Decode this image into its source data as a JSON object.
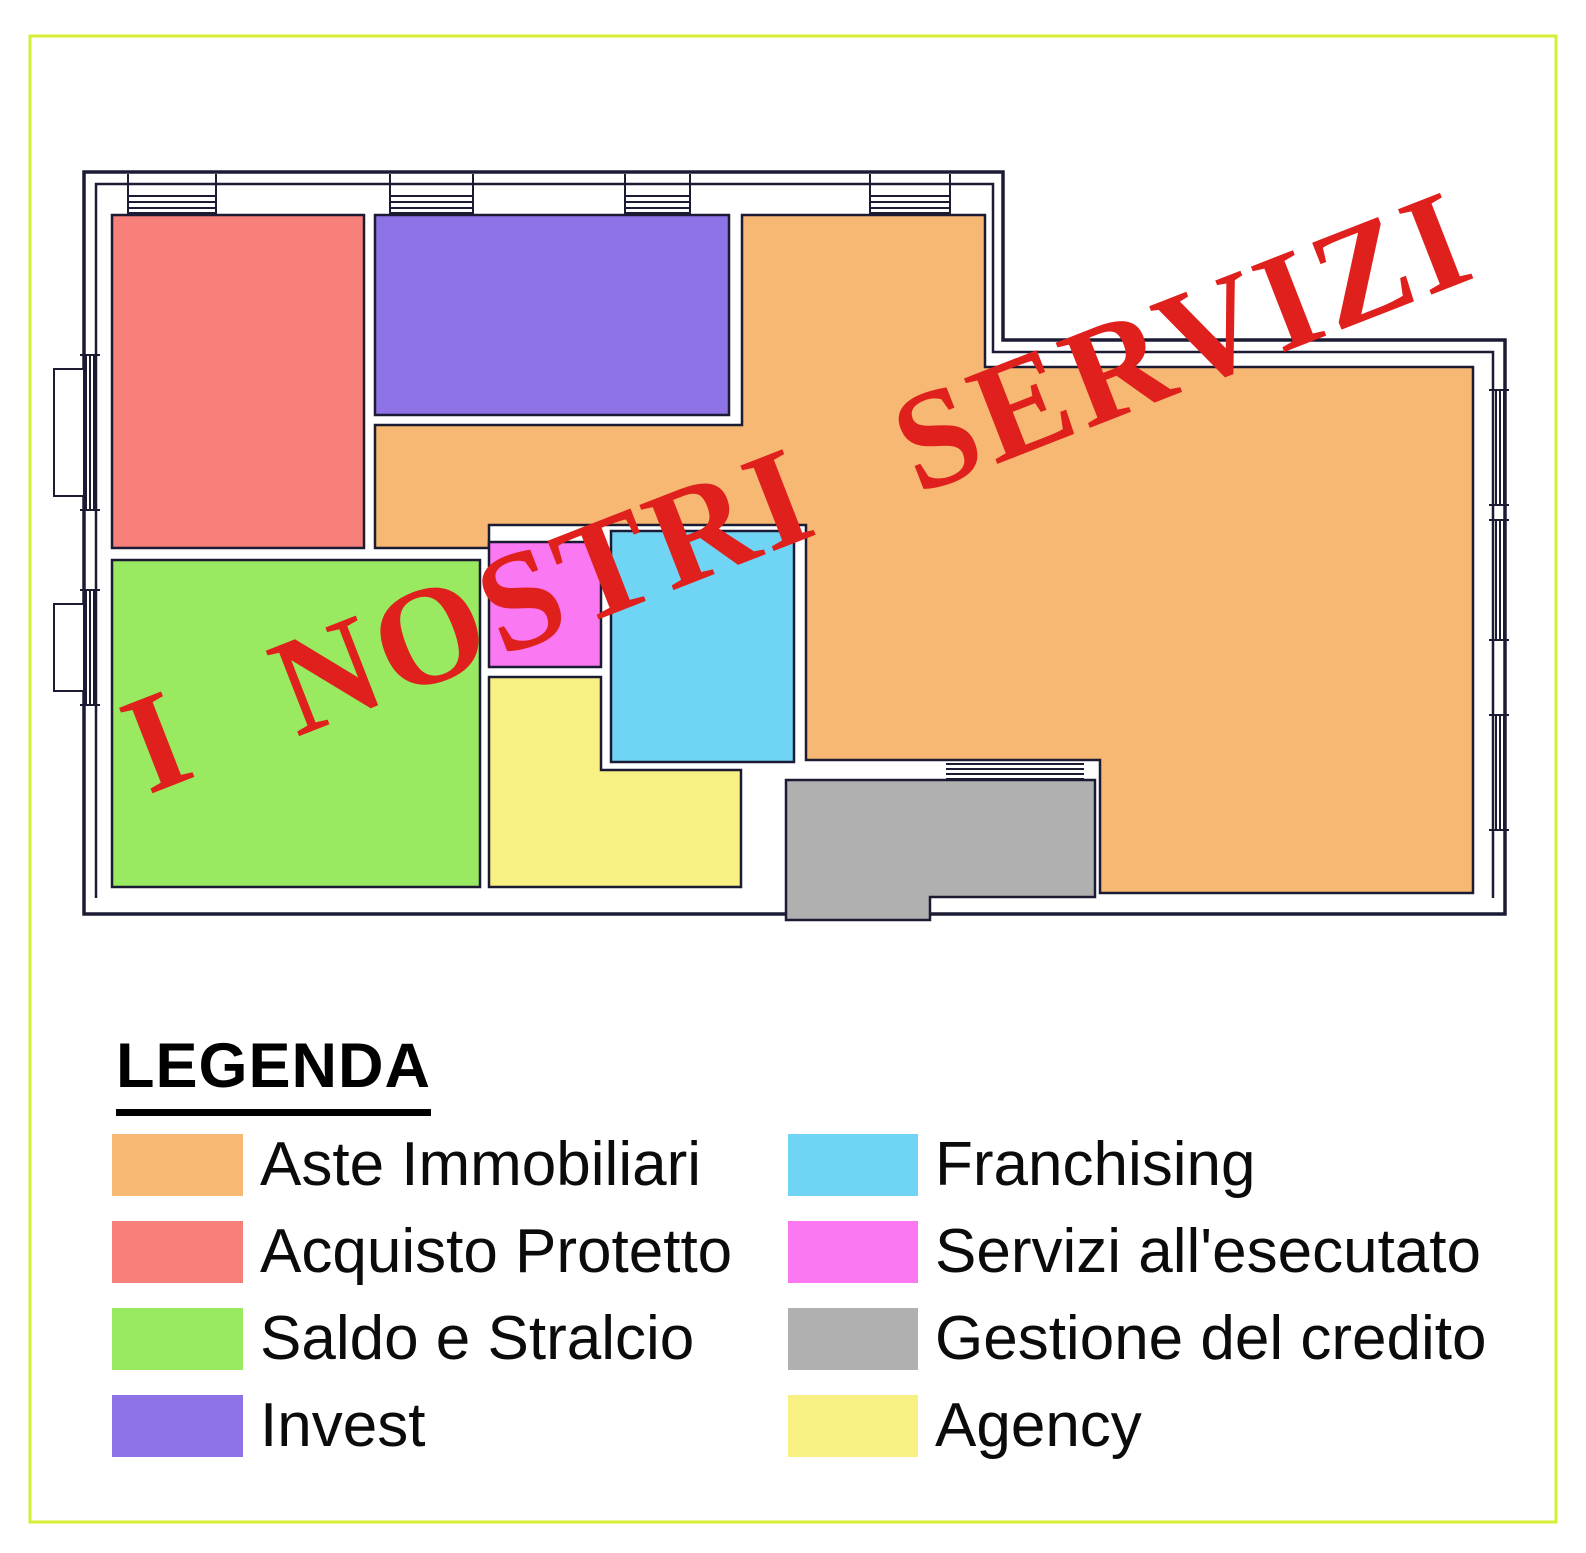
{
  "page": {
    "background": "#FFFFFF",
    "frame_color": "#D6EE34"
  },
  "plan": {
    "wall_color": "#1B1B33",
    "floor_color": "#FFFFFF"
  },
  "stamp": {
    "text": "I NOSTRI SERVIZI",
    "color": "#E0201C"
  },
  "colors": {
    "aste_immobiliari": "#F7B873",
    "acquisto_protetto": "#F8807A",
    "saldo_e_stralcio": "#99E961",
    "invest": "#8D73E6",
    "franchising": "#70D4F4",
    "servizi_esecutato": "#FA78F1",
    "gestione_credito": "#B0B0B0",
    "agency": "#F8F083"
  },
  "legend": {
    "title": "LEGENDA",
    "left": [
      {
        "key": "aste_immobiliari",
        "label": "Aste Immobiliari"
      },
      {
        "key": "acquisto_protetto",
        "label": "Acquisto Protetto"
      },
      {
        "key": "saldo_e_stralcio",
        "label": "Saldo e Stralcio"
      },
      {
        "key": "invest",
        "label": "Invest"
      }
    ],
    "right": [
      {
        "key": "franchising",
        "label": "Franchising"
      },
      {
        "key": "servizi_esecutato",
        "label": "Servizi all'esecutato"
      },
      {
        "key": "gestione_credito",
        "label": "Gestione del credito"
      },
      {
        "key": "agency",
        "label": "Agency"
      }
    ]
  }
}
